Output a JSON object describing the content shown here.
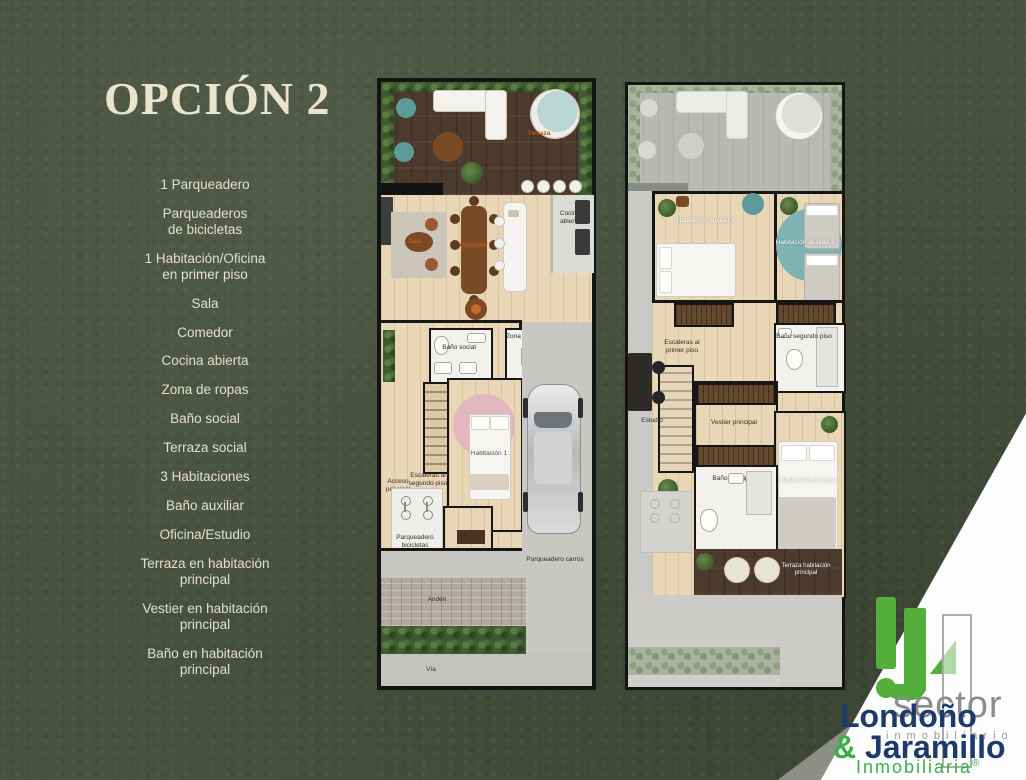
{
  "slide": {
    "title": "OPCIÓN 2"
  },
  "features": [
    "1 Parqueadero",
    "Parqueaderos\nde bicicletas",
    "1 Habitación/Oficina\nen primer piso",
    "Sala",
    "Comedor",
    "Cocina abierta",
    "Zona de ropas",
    "Baño social",
    "Terraza social",
    "3 Habitaciones",
    "Baño auxiliar",
    "Oficina/Estudio",
    "Terraza en habitación\nprincipal",
    "Vestier en habitación\nprincipal",
    "Baño en habitación\nprincipal"
  ],
  "plan1": {
    "labels": {
      "terraza": "Terraza",
      "sala": "Sala",
      "comedor": "Comedor",
      "cocina": "Cocina\nabierta",
      "bano_social": "Baño social",
      "zona_ropas": "Zona de ropas",
      "escaleras": "Escaleras al\nsegundo piso",
      "habitacion1": "Habitación 1",
      "acceso": "Acceso\nprincipal",
      "parq_bicicletas": "Parqueadero bicicletas",
      "parq_carros": "Parqueadero carros",
      "anden": "Andén",
      "via": "Vía"
    }
  },
  "plan2": {
    "labels": {
      "hab_aux2": "Habitación auxiliar 2",
      "hab_aux3": "Habitación auxiliar 3",
      "bano_segundo": "Baño segundo piso",
      "escaleras": "Escaleras al\nprimer piso",
      "estudio": "Estudio",
      "vestier": "Vestier principal",
      "bano_principal": "Baño principal",
      "hab_principal": "Habitación principal",
      "terraza_principal": "Terraza habitación principal"
    }
  },
  "logo": {
    "name_line1": "Londoño",
    "ampersand": "&",
    "name_line2": " Jaramillo",
    "subtitle": "Inmobiliaria",
    "registered": "®",
    "watermark_1": "sector",
    "watermark_2": "inmobiliario",
    "colors": {
      "navy": "#1d3a6d",
      "green": "#3cae49",
      "gray": "#8a8c8e"
    }
  },
  "colors": {
    "background": "#48523e",
    "cream": "#e7dfc6",
    "label_orange": "#b4561e"
  }
}
